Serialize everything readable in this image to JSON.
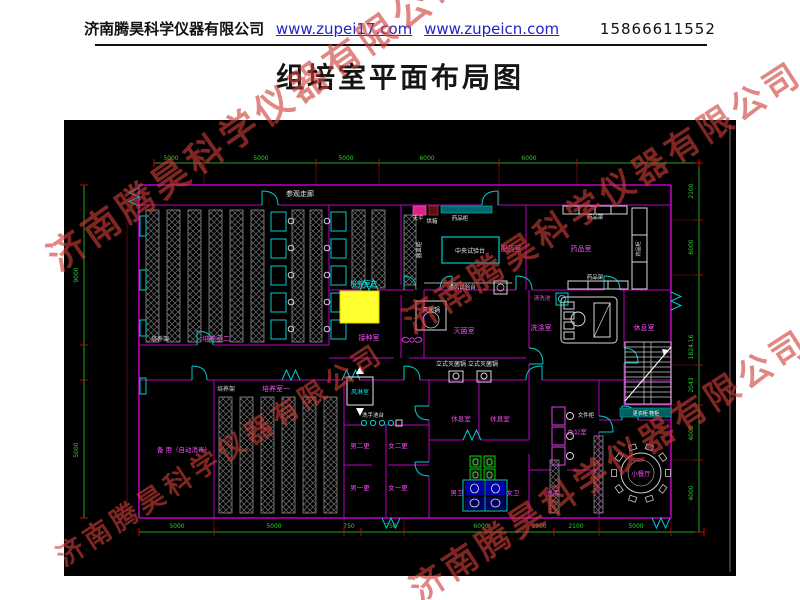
{
  "header": {
    "company": "济南腾昊科学仪器有限公司",
    "link1": "www.zupei17.com",
    "link2": "www.zupeicn.com",
    "phone": "15866611552"
  },
  "title": "组培室平面布局图",
  "watermark": {
    "text": "济南腾昊科学仪器有限公司",
    "color_rgba": "rgba(205,60,55,0.62)"
  },
  "colors": {
    "canvas": "#000000",
    "wall": "#bf00bf",
    "dim_line": "#21a321",
    "dim_text": "#2ecc2e",
    "tick": "#d00000",
    "fixture": "#00cccc",
    "rack": "#909090",
    "highlight": "#ffff2e",
    "room_label": "#f050f0",
    "white_label": "#e8e8e8",
    "cyan_label": "#00e5e5",
    "link": "#2222cc"
  },
  "plan": {
    "labels": [
      {
        "t": "参观走廊",
        "x": 236,
        "y": 76,
        "c": "#e8e8e8",
        "s": 7
      },
      {
        "t": "培养架",
        "x": 96,
        "y": 221,
        "c": "#dcdcdc",
        "s": 6
      },
      {
        "t": "培养室二",
        "x": 152,
        "y": 221,
        "c": "#f050f0",
        "s": 7
      },
      {
        "t": "培养室三",
        "x": 300,
        "y": 166,
        "c": "#00e5e5",
        "s": 7
      },
      {
        "t": "培养架",
        "x": 162,
        "y": 271,
        "c": "#dcdcdc",
        "s": 6
      },
      {
        "t": "培养室一",
        "x": 212,
        "y": 271,
        "c": "#f050f0",
        "s": 7
      },
      {
        "t": "接种室",
        "x": 305,
        "y": 220,
        "c": "#f050f0",
        "s": 7
      },
      {
        "t": "灭菌锅",
        "x": 367,
        "y": 192,
        "c": "#e8e8e8",
        "s": 6
      },
      {
        "t": "灭菌室",
        "x": 400,
        "y": 213,
        "c": "#f050f0",
        "s": 7
      },
      {
        "t": "立式灭菌锅 立式灭菌锅",
        "x": 403,
        "y": 246,
        "c": "#e8e8e8",
        "s": 6
      },
      {
        "t": "配药室",
        "x": 447,
        "y": 131,
        "c": "#f050f0",
        "s": 7
      },
      {
        "t": "中央试验台",
        "x": 406,
        "y": 133,
        "c": "#e8e8e8",
        "s": 6
      },
      {
        "t": "天平",
        "x": 354,
        "y": 100,
        "c": "#e8e8e8",
        "s": 5.5
      },
      {
        "t": "烘箱",
        "x": 368,
        "y": 103,
        "c": "#e8e8e8",
        "s": 5.5
      },
      {
        "t": "药品柜",
        "x": 396,
        "y": 100,
        "c": "#e8e8e8",
        "s": 5.5
      },
      {
        "t": "通风试验台",
        "x": 398,
        "y": 169,
        "c": "#e8e8e8",
        "s": 5.5
      },
      {
        "t": "器皿柜",
        "x": 357,
        "y": 130,
        "c": "#e8e8e8",
        "s": 5.5,
        "r": -90
      },
      {
        "t": "药品室",
        "x": 517,
        "y": 131,
        "c": "#f050f0",
        "s": 7
      },
      {
        "t": "药品架",
        "x": 531,
        "y": 99,
        "c": "#e8e8e8",
        "s": 5.5
      },
      {
        "t": "药品架",
        "x": 531,
        "y": 159,
        "c": "#e8e8e8",
        "s": 5.5
      },
      {
        "t": "药品柜",
        "x": 576,
        "y": 129,
        "c": "#e8e8e8",
        "s": 5,
        "r": -90
      },
      {
        "t": "清洗池",
        "x": 478,
        "y": 180,
        "c": "#f050f0",
        "s": 5.5
      },
      {
        "t": "洗涤室",
        "x": 477,
        "y": 210,
        "c": "#f050f0",
        "s": 7
      },
      {
        "t": "休息室",
        "x": 580,
        "y": 210,
        "c": "#f050f0",
        "s": 7
      },
      {
        "t": "备 用（自动消毒）",
        "x": 120,
        "y": 332,
        "c": "#f050f0",
        "s": 6.5
      },
      {
        "t": "风淋室",
        "x": 296,
        "y": 274,
        "c": "#00e5e5",
        "s": 6
      },
      {
        "t": "洗手池台",
        "x": 309,
        "y": 297,
        "c": "#e8e8e8",
        "s": 5.5
      },
      {
        "t": "男二更",
        "x": 296,
        "y": 328,
        "c": "#f050f0",
        "s": 6.5
      },
      {
        "t": "女二更",
        "x": 334,
        "y": 328,
        "c": "#f050f0",
        "s": 6.5
      },
      {
        "t": "男一更",
        "x": 296,
        "y": 370,
        "c": "#f050f0",
        "s": 6.5
      },
      {
        "t": "女一更",
        "x": 334,
        "y": 370,
        "c": "#f050f0",
        "s": 6.5
      },
      {
        "t": "休息室",
        "x": 397,
        "y": 301,
        "c": "#f050f0",
        "s": 6.5
      },
      {
        "t": "休息室",
        "x": 436,
        "y": 301,
        "c": "#f050f0",
        "s": 6.5
      },
      {
        "t": "男卫",
        "x": 393,
        "y": 375,
        "c": "#f050f0",
        "s": 6.5
      },
      {
        "t": "女卫",
        "x": 449,
        "y": 375,
        "c": "#f050f0",
        "s": 6.5
      },
      {
        "t": "办公室",
        "x": 513,
        "y": 314,
        "c": "#f050f0",
        "s": 6.5
      },
      {
        "t": "文件柜",
        "x": 522,
        "y": 297,
        "c": "#e8e8e8",
        "s": 5.5
      },
      {
        "t": "仓库",
        "x": 489,
        "y": 375,
        "c": "#f050f0",
        "s": 6.5
      },
      {
        "t": "小餐厅",
        "x": 577,
        "y": 356,
        "c": "#f050f0",
        "s": 6.5
      },
      {
        "t": "更衣柜 鞋柜",
        "x": 582,
        "y": 295,
        "c": "#ffffff",
        "s": 5
      }
    ],
    "dims": {
      "top": {
        "y": 40,
        "items": [
          {
            "v": "5000",
            "x": 107
          },
          {
            "v": "5000",
            "x": 197
          },
          {
            "v": "5000",
            "x": 282
          },
          {
            "v": "6000",
            "x": 363
          },
          {
            "v": "6000",
            "x": 465
          }
        ]
      },
      "bottom": {
        "y": 408,
        "items": [
          {
            "v": "5000",
            "x": 113
          },
          {
            "v": "5000",
            "x": 210
          },
          {
            "v": "750",
            "x": 285
          },
          {
            "v": "750",
            "x": 327
          },
          {
            "v": "6000",
            "x": 417
          },
          {
            "v": "1500",
            "x": 475
          },
          {
            "v": "2100",
            "x": 512
          },
          {
            "v": "5000",
            "x": 572
          }
        ]
      },
      "right": {
        "x": 629,
        "items": [
          {
            "v": "2100",
            "y": 71
          },
          {
            "v": "6000",
            "y": 127
          },
          {
            "v": "1824.16",
            "y": 227
          },
          {
            "v": "2043",
            "y": 265
          },
          {
            "v": "4000",
            "y": 313
          },
          {
            "v": "4000",
            "y": 373
          }
        ]
      },
      "left": {
        "x": 14,
        "items": [
          {
            "v": "9000",
            "y": 155
          },
          {
            "v": "5000",
            "y": 330
          }
        ]
      }
    },
    "dining": {
      "cx": 577,
      "cy": 353,
      "r": 20,
      "chairs": 10
    }
  }
}
